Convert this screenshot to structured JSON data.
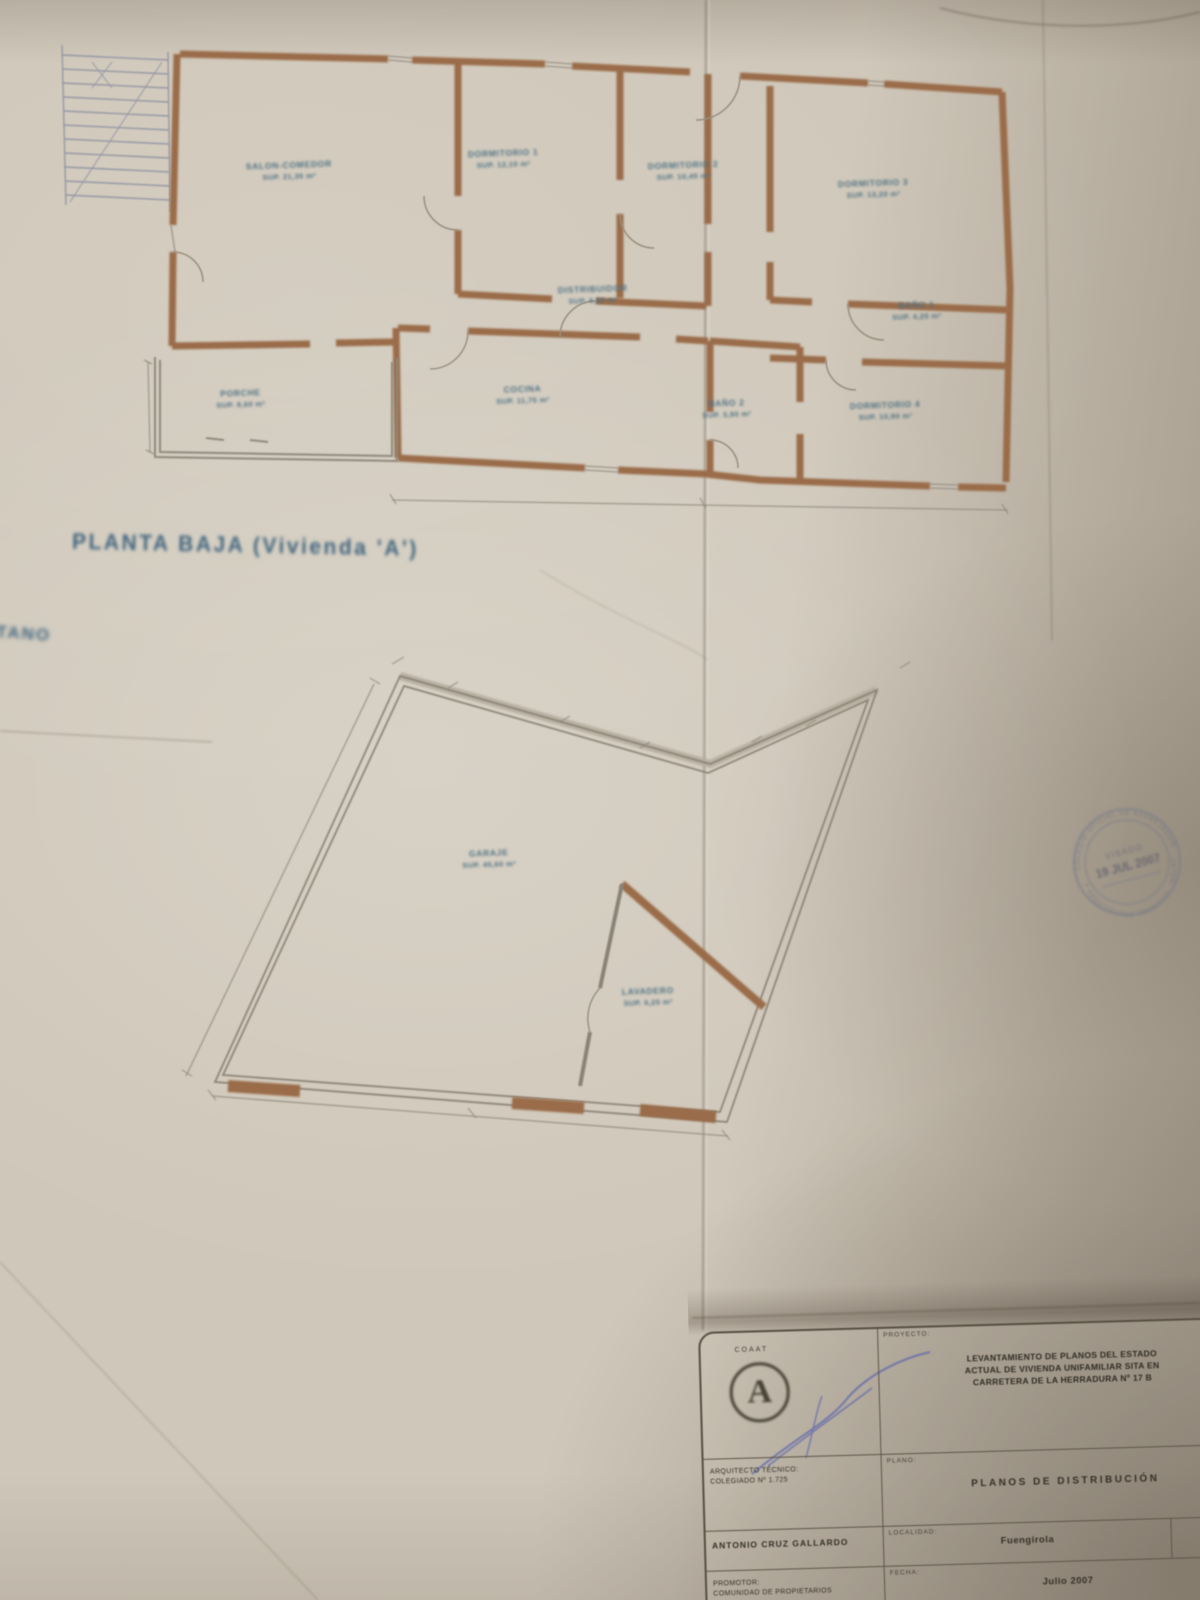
{
  "captions": {
    "upper_plan": "PLANTA BAJA (Vivienda 'A')",
    "margin_fragment": "PLANTA SÓTANO"
  },
  "upper_rooms": [
    {
      "name": "SALON-COMEDOR",
      "area": "SUP. 21,35 m²"
    },
    {
      "name": "DORMITORIO 1",
      "area": "SUP. 12,10 m²"
    },
    {
      "name": "DORMITORIO 2",
      "area": "SUP. 10,45 m²"
    },
    {
      "name": "DORMITORIO 3",
      "area": "SUP. 13,20 m²"
    },
    {
      "name": "DISTRIBUIDOR",
      "area": "SUP. 6,80 m²"
    },
    {
      "name": "BAÑO 1",
      "area": "SUP. 4,25 m²"
    },
    {
      "name": "PORCHE",
      "area": "SUP. 8,60 m²"
    },
    {
      "name": "COCINA",
      "area": "SUP. 11,75 m²"
    },
    {
      "name": "BAÑO 2",
      "area": "SUP. 3,90 m²"
    },
    {
      "name": "DORMITORIO 4",
      "area": "SUP. 10,90 m²"
    }
  ],
  "lower_rooms": [
    {
      "name": "GARAJE",
      "area": "SUP. 45,60 m²"
    },
    {
      "name": "LAVADERO",
      "area": "SUP. 6,25 m²"
    }
  ],
  "stamp": {
    "ring_top": "COLEGIO OFICIAL DE APAREJADORES",
    "ring_bottom": "Y ARQUITECTOS TÉCNICOS · MÁLAGA",
    "date": "19 JUL 2007",
    "sub": "VISADO"
  },
  "title_block": {
    "proyecto_label": "PROYECTO:",
    "proyecto_line1": "LEVANTAMIENTO DE PLANOS DEL ESTADO",
    "proyecto_line2": "ACTUAL DE VIVIENDA UNIFAMILIAR SITA EN",
    "proyecto_line3": "CARRETERA DE LA HERRADURA Nº 17 B",
    "proyecto_corner": "VILLA",
    "logo_letter": "A",
    "logo_caption": "COAAT",
    "tecnico_label": "ARQUITECTO TÉCNICO:",
    "tecnico_colegiado": "COLEGIADO Nº 1.725",
    "tecnico_name": "ANTONIO CRUZ GALLARDO",
    "plano_label": "PLANO:",
    "plano_value": "PLANOS DE DISTRIBUCIÓN",
    "localidad_label": "LOCALIDAD:",
    "localidad_value": "Fuengirola",
    "escala_value": "1/50",
    "fecha_label": "FECHA:",
    "fecha_value": "Julio 2007",
    "promotor_label": "PROMOTOR:",
    "promotor_value": "COMUNIDAD DE PROPIETARIOS"
  }
}
